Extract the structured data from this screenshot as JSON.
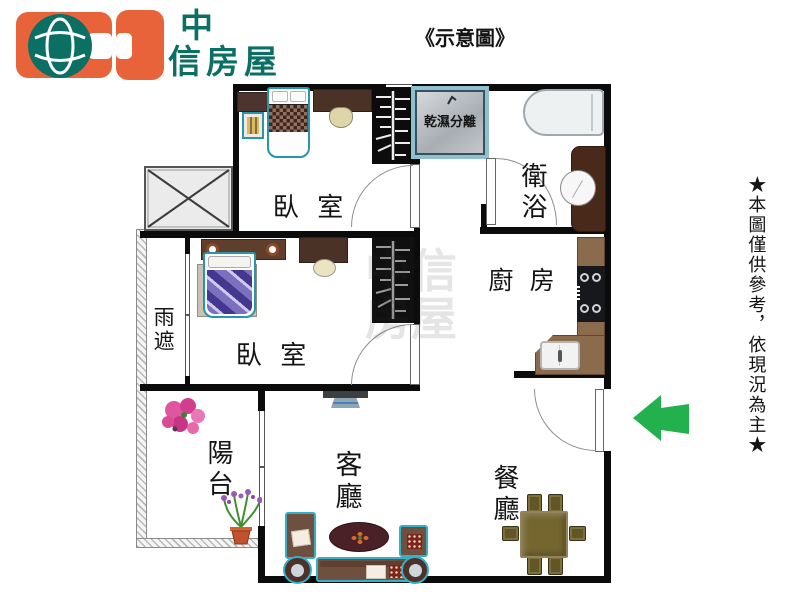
{
  "header": {
    "logo": {
      "line1": "中",
      "line2": "信房屋"
    },
    "title": "《示意圖》"
  },
  "note": "★本圖僅供參考，依現況為主★",
  "rooms": {
    "bedroom1": "臥 室",
    "bedroom2": "臥 室",
    "bathroom": "衛浴",
    "kitchen": "廚 房",
    "living": "客廳",
    "dining": "餐廳",
    "balcony": "陽台",
    "rain_shelter": "雨遮",
    "shower": "乾濕分離"
  },
  "watermark": "中信房屋",
  "colors": {
    "logo_orange": "#e8633a",
    "logo_teal": "#0c6f63",
    "arrow_green": "#22b14c",
    "wall_black": "#0b0b0b"
  }
}
